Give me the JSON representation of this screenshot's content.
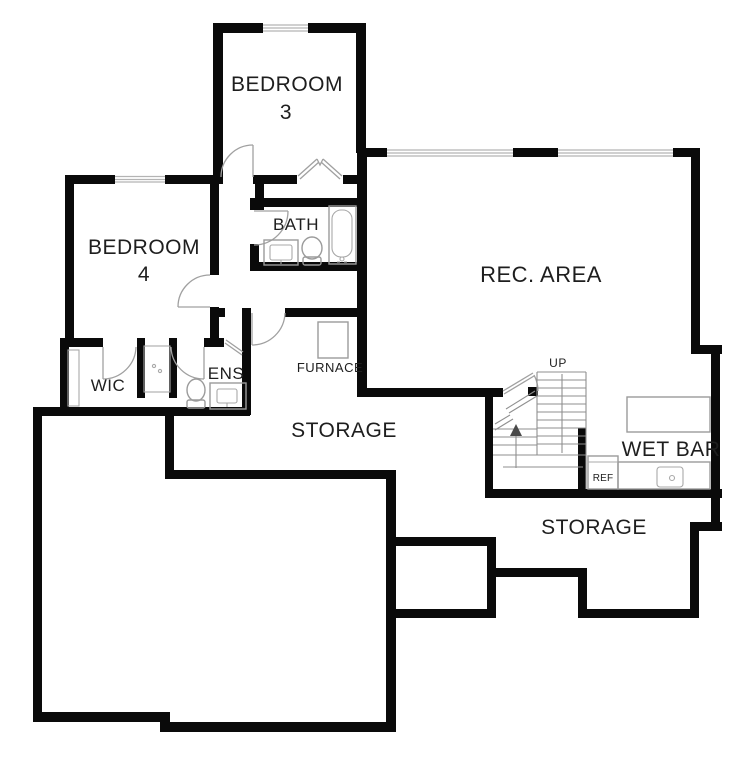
{
  "plan_title": "Basement floor plan",
  "colors": {
    "walls": "#0a0a0a",
    "background": "#ffffff",
    "fixture_lines": "#9b9b9b",
    "text": "#1e1e1e"
  },
  "labels": {
    "bedroom3_line1": "BEDROOM",
    "bedroom3_line2": "3",
    "bedroom4_line1": "BEDROOM",
    "bedroom4_line2": "4",
    "bath": "BATH",
    "wic": "WIC",
    "ens": "ENS",
    "furnace": "FURNACE",
    "storage_middle": "STORAGE",
    "rec_area": "REC. AREA",
    "up": "UP",
    "wet_bar": "WET BAR",
    "ref": "REF",
    "storage_lower": "STORAGE"
  },
  "fixtures": [
    "bathtub",
    "toilet",
    "vanity-sink",
    "shower",
    "furnace-unit",
    "walk-in-closet-shelf",
    "staircase",
    "up-arrow",
    "refrigerator",
    "wet-bar-counter",
    "bar-sink",
    "door-swing",
    "bifold-closet-door",
    "window"
  ]
}
